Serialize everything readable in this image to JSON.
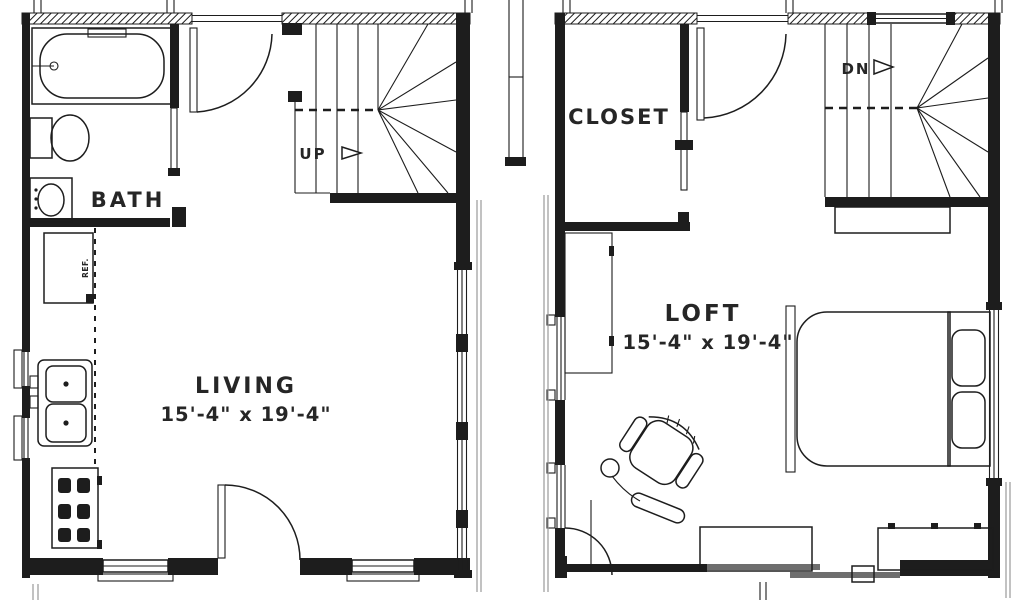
{
  "title": "Tiny house floor plan drawing",
  "colors": {
    "background": "#ffffff",
    "line": "#1d1d1d",
    "shadow": "#9a9a9a",
    "text": "#262626"
  },
  "plans": {
    "first_floor": {
      "rooms": {
        "bath": {
          "label": "BATH"
        },
        "living": {
          "label": "LIVING",
          "dimensions": "15'-4\" x 19'-4\""
        }
      },
      "stairs": {
        "direction_label": "UP"
      },
      "appliances": {
        "refrigerator_label": "REF."
      }
    },
    "second_floor": {
      "rooms": {
        "closet": {
          "label": "CLOSET"
        },
        "loft": {
          "label": "LOFT",
          "dimensions": "15'-4\" x 19'-4\""
        }
      },
      "stairs": {
        "direction_label": "DN"
      }
    }
  }
}
